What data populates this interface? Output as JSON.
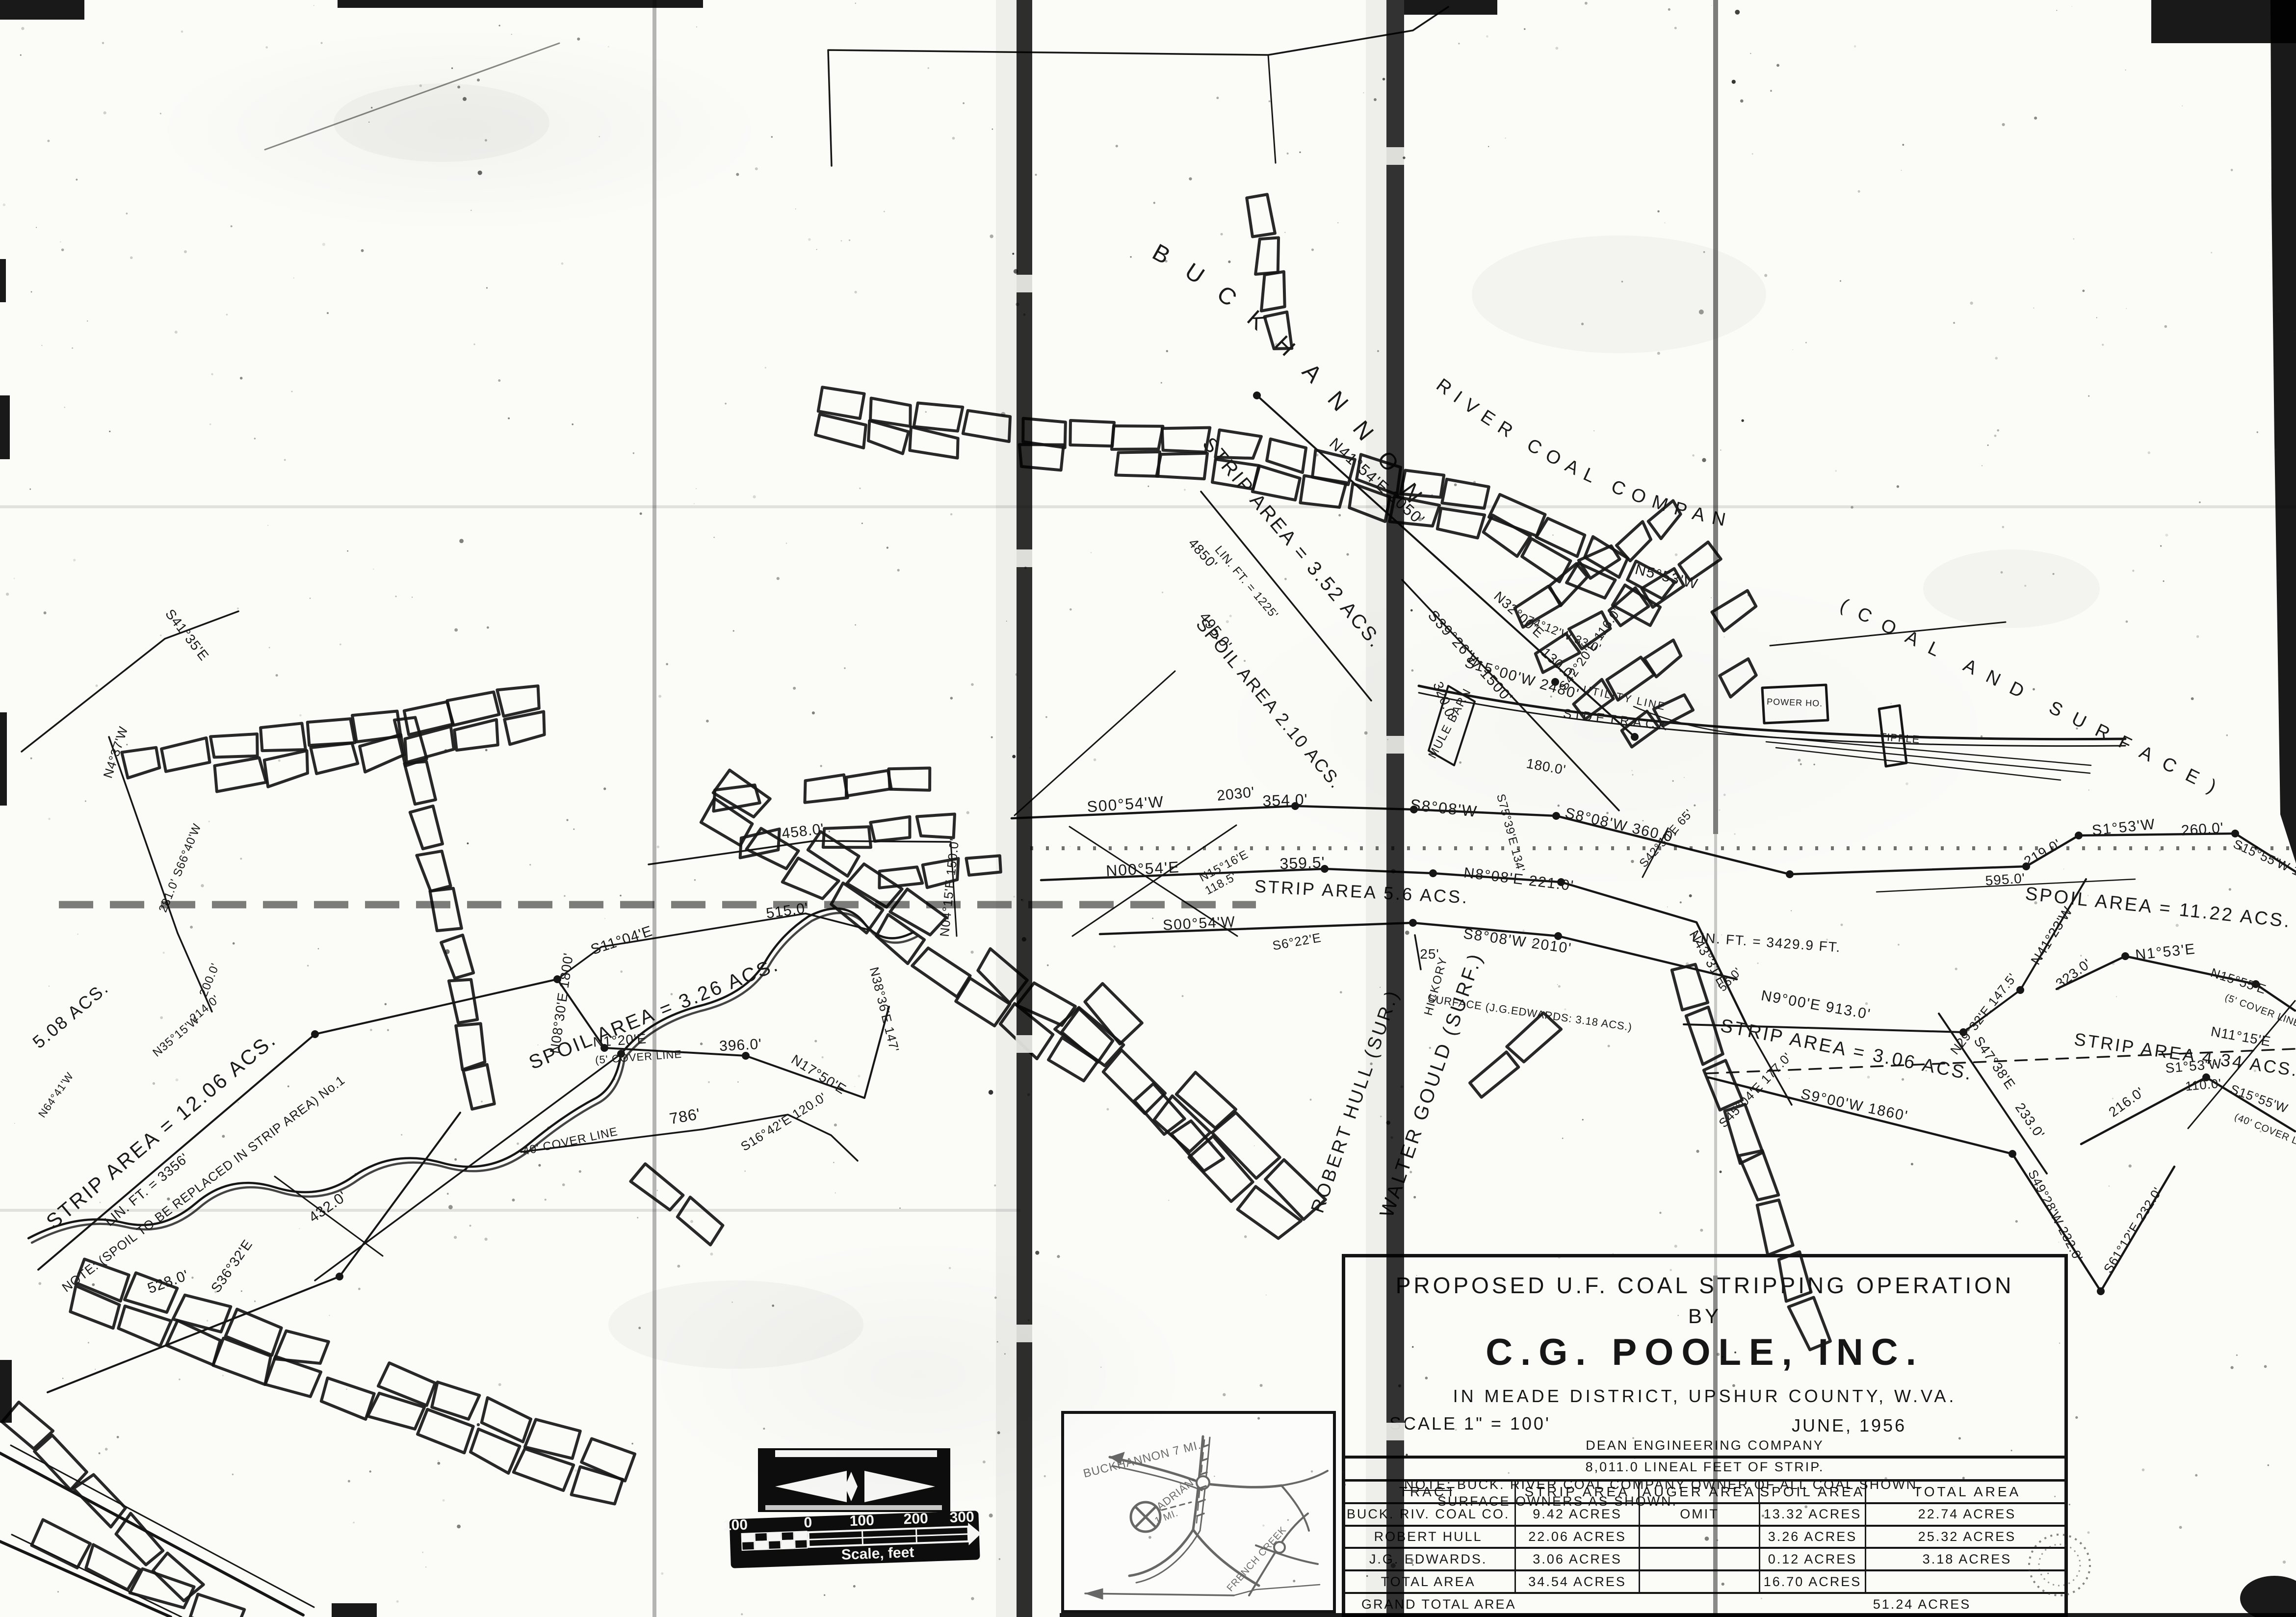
{
  "paper": {
    "ink_color": "#161616",
    "background_color": "#fbfbf8"
  },
  "title_block": {
    "line1": "PROPOSED U.F. COAL STRIPPING OPERATION",
    "line2": "BY",
    "line3": "C.G. POOLE, INC.",
    "line4": "IN MEADE DISTRICT, UPSHUR COUNTY, W.VA.",
    "scale": "SCALE 1\" = 100'",
    "date": "JUNE, 1956",
    "firm": "DEAN ENGINEERING COMPANY",
    "lineal": "8,011.0 LINEAL FEET OF STRIP."
  },
  "note": {
    "heading": "NOTE:",
    "line1": "BUCK. RIVER COAL COMPANY OWNER OF ALL COAL SHOWN.",
    "line2": "SURFACE OWNERS AS SHOWN."
  },
  "table": {
    "headers": [
      "TRACT",
      "STRIP AREA",
      "AUGER AREA",
      "SPOIL AREA",
      "TOTAL AREA"
    ],
    "rows": [
      [
        "BUCK. RIV. COAL CO.",
        "9.42 ACRES",
        "OMIT",
        "13.32 ACRES",
        "22.74 ACRES"
      ],
      [
        "ROBERT HULL",
        "22.06 ACRES",
        "",
        "3.26 ACRES",
        "25.32 ACRES"
      ],
      [
        "J.G. EDWARDS.",
        "3.06 ACRES",
        "",
        "0.12 ACRES",
        "3.18 ACRES"
      ],
      [
        "TOTAL AREA",
        "34.54 ACRES",
        "",
        "16.70 ACRES",
        ""
      ]
    ],
    "grand_label": "GRAND TOTAL AREA",
    "grand_value": "51.24 ACRES"
  },
  "scale_bar": {
    "ticks": [
      "100",
      "0",
      "100",
      "200",
      "300"
    ],
    "label": "Scale, feet"
  },
  "inset": {
    "labels": [
      "BUCKHANNON 7 MI.",
      "ADRIAN",
      "1 MI.",
      "FRENCH CREEK"
    ]
  },
  "arc_texts": [
    {
      "id": "arc-buckhannon",
      "text": "BUCKHANNON",
      "size": 48,
      "ls": 44
    },
    {
      "id": "arc-rivercoal",
      "text": "RIVER COAL COMPANY",
      "size": 38,
      "ls": 16
    },
    {
      "id": "arc-coalsurface",
      "text": "(COAL AND SURFACE)",
      "size": 38,
      "ls": 26
    }
  ],
  "map_labels": [
    [
      "N41°54'E 2050'",
      2800,
      990,
      42,
      32,
      2
    ],
    [
      "N32°00'E",
      3090,
      1260,
      42,
      28,
      1
    ],
    [
      "130.0'",
      3170,
      1360,
      42,
      28,
      1
    ],
    [
      "STRIP AREA = 3.52 ACS.",
      2625,
      1115,
      50,
      40,
      4
    ],
    [
      "LIN. FT. = 1225'",
      2535,
      1192,
      50,
      24,
      1
    ],
    [
      "495.0'",
      2470,
      1292,
      52,
      30,
      1
    ],
    [
      "4850'",
      2445,
      1135,
      48,
      28,
      1
    ],
    [
      "SPOIL AREA 2.10 ACS.",
      2578,
      1442,
      50,
      36,
      3
    ],
    [
      "S39°26'W 1500'",
      2990,
      1345,
      48,
      30,
      2
    ],
    [
      "N5°53'W",
      3395,
      1185,
      14,
      30,
      2
    ],
    [
      "74°12'W 33.0'",
      3185,
      1300,
      22,
      24,
      1
    ],
    [
      "UTILITY LINE",
      3310,
      1430,
      12,
      22,
      3
    ],
    [
      "180.0'",
      3150,
      1572,
      10,
      28,
      1
    ],
    [
      "S15°00'W 2480'",
      3100,
      1392,
      16,
      30,
      2
    ],
    [
      "S42°20'E 116.0'",
      3248,
      1328,
      -55,
      26,
      1
    ],
    [
      "320.0'",
      2936,
      1432,
      68,
      28,
      1
    ],
    [
      "MULE BARN",
      2962,
      1478,
      -62,
      24,
      2
    ],
    [
      "SIDETRACK",
      3295,
      1476,
      7,
      26,
      8
    ],
    [
      "TIPPLE",
      3872,
      1512,
      4,
      22,
      1
    ],
    [
      "POWER HO.",
      3658,
      1438,
      2,
      18,
      1
    ],
    [
      "S75°39'E 134'",
      3072,
      1700,
      75,
      24,
      1
    ],
    [
      "S8°08'W 360.0'",
      3302,
      1692,
      13,
      30,
      2
    ],
    [
      "S42°30'E 65'",
      3402,
      1714,
      -48,
      24,
      1
    ],
    [
      "2030'",
      2520,
      1628,
      -6,
      30,
      1
    ],
    [
      "S00°54'W",
      2295,
      1650,
      -4,
      32,
      2
    ],
    [
      "354.0'",
      2620,
      1642,
      -2,
      32,
      1
    ],
    [
      "S8°08'W",
      2942,
      1658,
      6,
      32,
      2
    ],
    [
      "N15°16'E",
      2498,
      1772,
      -28,
      24,
      1
    ],
    [
      "118.5'",
      2492,
      1808,
      -28,
      24,
      1
    ],
    [
      "N00°54'E",
      2330,
      1782,
      -3,
      32,
      2
    ],
    [
      "359.5'",
      2655,
      1770,
      -2,
      32,
      1
    ],
    [
      "N8°08'E 221.0'",
      3095,
      1802,
      7,
      30,
      2
    ],
    [
      "N43°31'E",
      3474,
      1958,
      60,
      28,
      1
    ],
    [
      "STRIP AREA 5.6 ACS.",
      2775,
      1830,
      3,
      36,
      4
    ],
    [
      "S00°54'W",
      2445,
      1892,
      -3,
      30,
      2
    ],
    [
      "S8°08'W 2010'",
      3092,
      1928,
      8,
      30,
      2
    ],
    [
      "25'",
      2914,
      1954,
      0,
      28,
      1
    ],
    [
      "S6°22'E",
      2645,
      1928,
      -10,
      26,
      1
    ],
    [
      "HICKORY",
      2934,
      2012,
      -75,
      24,
      2
    ],
    [
      "WALTER GOULD (SURF.)",
      2930,
      2215,
      -71,
      40,
      5
    ],
    [
      "ROBERT HULL (SUR.)",
      2774,
      2248,
      -71,
      38,
      5
    ],
    [
      "SURFACE (J.G.EDWARDS: 3.18 ACS.)",
      3118,
      2072,
      8,
      22,
      1
    ],
    [
      "219.0'",
      4168,
      1746,
      -30,
      28,
      1
    ],
    [
      "S1°53'W",
      4330,
      1696,
      -6,
      30,
      2
    ],
    [
      "260.0'",
      4490,
      1700,
      -4,
      30,
      1
    ],
    [
      "S15°55'W 177'",
      4634,
      1764,
      24,
      26,
      1
    ],
    [
      "SPOIL AREA = 11.22 ACS.",
      4398,
      1862,
      6,
      38,
      4
    ],
    [
      "323.0'",
      4232,
      1992,
      -36,
      28,
      1
    ],
    [
      "N1°53'E",
      4415,
      1950,
      -6,
      30,
      2
    ],
    [
      "N15°55'E",
      4560,
      2008,
      18,
      26,
      1
    ],
    [
      "(5' COVER LINE",
      4610,
      2066,
      20,
      20,
      1
    ],
    [
      "STRIP AREA 4.34 ACS.",
      4455,
      2162,
      8,
      36,
      4
    ],
    [
      "216.0'",
      4340,
      2254,
      -36,
      28,
      1
    ],
    [
      "S1°53'W",
      4472,
      2182,
      -5,
      28,
      1
    ],
    [
      "110.0'",
      4492,
      2220,
      -5,
      26,
      1
    ],
    [
      "S15°55'W",
      4602,
      2248,
      20,
      26,
      1
    ],
    [
      "(40' COVER LINE",
      4634,
      2314,
      22,
      20,
      1
    ],
    [
      "S47°38'E",
      4058,
      2172,
      55,
      28,
      1
    ],
    [
      "233.0'",
      4130,
      2290,
      55,
      28,
      1
    ],
    [
      "S61°12'E 232.0'",
      4355,
      2512,
      -58,
      26,
      1
    ],
    [
      "S49°28'W 232.0'",
      4182,
      2482,
      62,
      26,
      1
    ],
    [
      "S9°00'W 1860'",
      3778,
      2262,
      12,
      30,
      2
    ],
    [
      "STRIP AREA = 3.06 ACS.",
      3762,
      2152,
      11,
      38,
      4
    ],
    [
      "N9°00'E 913.0'",
      3700,
      2058,
      10,
      30,
      2
    ],
    [
      "LIN. FT. = 3429.9 FT.",
      3600,
      1930,
      4,
      28,
      2
    ],
    [
      "N29°32'E 147.5'",
      4050,
      2072,
      -52,
      26,
      1
    ],
    [
      "N41°23'W",
      4190,
      1912,
      -58,
      28,
      1
    ],
    [
      "S45°04'E 177.0'",
      3584,
      2228,
      -46,
      26,
      1
    ],
    [
      "56.0'",
      3532,
      2002,
      -46,
      24,
      1
    ],
    [
      "595.0'",
      4088,
      1802,
      -4,
      28,
      1
    ],
    [
      "N11°15'E",
      4566,
      2122,
      10,
      28,
      1
    ],
    [
      "5.08 ACS.",
      152,
      2078,
      -40,
      36,
      3
    ],
    [
      "STRIP AREA = 12.06 ACS.",
      338,
      2315,
      -40,
      42,
      4
    ],
    [
      "LIN. FT. = 3356'",
      305,
      2432,
      -40,
      28,
      1
    ],
    [
      "NOTE: (SPOIL TO BE REPLACED IN STRIP AREA) No.1",
      420,
      2420,
      -37,
      26,
      1
    ],
    [
      "528.0'",
      346,
      2622,
      -20,
      30,
      1
    ],
    [
      "S36°32'E",
      480,
      2586,
      -55,
      28,
      1
    ],
    [
      "N35°15'W",
      364,
      2118,
      -40,
      24,
      1
    ],
    [
      "214.0'",
      422,
      2062,
      -40,
      24,
      1
    ],
    [
      "N64°41'W",
      120,
      2236,
      -55,
      22,
      1
    ],
    [
      "N08°30'E 1800'",
      1154,
      2046,
      -82,
      28,
      1
    ],
    [
      "S11°04'E",
      1270,
      1926,
      -18,
      30,
      1
    ],
    [
      "515.0'",
      1606,
      1866,
      -8,
      30,
      1
    ],
    [
      "SPOIL AREA = 3.26 ACS.",
      1338,
      2078,
      -22,
      40,
      4
    ],
    [
      "N1°20'E",
      1264,
      2130,
      -4,
      28,
      1
    ],
    [
      "(5' COVER LINE",
      1302,
      2162,
      -4,
      22,
      1
    ],
    [
      "396.0'",
      1510,
      2140,
      -3,
      30,
      1
    ],
    [
      "N17°50'E",
      1664,
      2198,
      32,
      28,
      1
    ],
    [
      "786'",
      1398,
      2286,
      -10,
      32,
      1
    ],
    [
      "40' COVER LINE",
      1164,
      2334,
      -12,
      24,
      1
    ],
    [
      "S16°42'E 120.0'",
      1602,
      2294,
      -32,
      26,
      1
    ],
    [
      "N38°36'E 147'",
      1794,
      2060,
      76,
      26,
      1
    ],
    [
      "458.0'",
      1638,
      1704,
      -7,
      30,
      1
    ],
    [
      "N04°15'E 150.0'",
      1944,
      1810,
      -84,
      26,
      1
    ],
    [
      "S41°35'E",
      374,
      1300,
      52,
      28,
      1
    ],
    [
      "N4°37'W",
      244,
      1536,
      -72,
      26,
      1
    ],
    [
      "281.0' S66°40'W",
      374,
      1772,
      -68,
      24,
      1
    ],
    [
      "200.0'",
      434,
      2000,
      -68,
      24,
      1
    ],
    [
      "432.0'",
      674,
      2468,
      -35,
      30,
      1
    ]
  ]
}
